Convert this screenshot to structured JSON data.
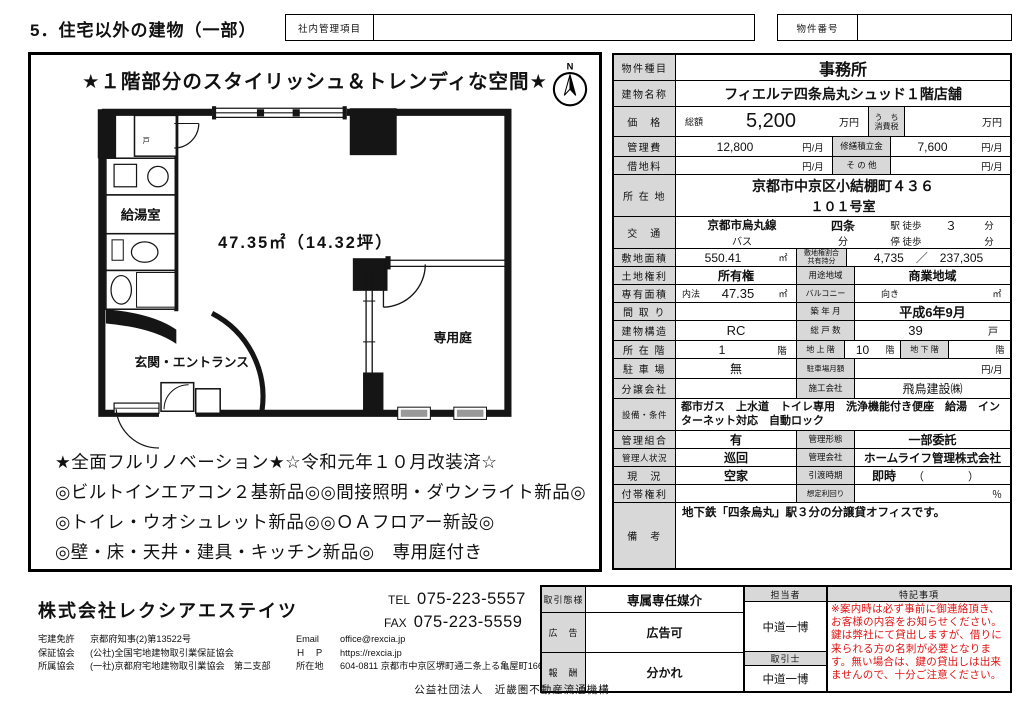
{
  "colors": {
    "label_bg": "#d8d8d8",
    "notes_red": "#e01212",
    "line": "#000000"
  },
  "header": {
    "title": "5．住宅以外の建物（一部）",
    "internal_label": "社内管理項目",
    "internal_value": "",
    "property_no_label": "物件番号",
    "property_no_value": ""
  },
  "plan": {
    "headline": "★１階部分のスタイリッシュ＆トレンディな空間★",
    "compass_n": "N",
    "door_label": "戸",
    "room_kyuto": "給湯室",
    "area_text": "47.35㎡（14.32坪）",
    "room_entrance": "玄関・エントランス",
    "room_garden": "専用庭",
    "features": [
      "★全面フルリノベーション★☆令和元年１０月改装済☆",
      "◎ビルトインエアコン２基新品◎◎間接照明・ダウンライト新品◎",
      "◎トイレ・ウオシュレット新品◎◎ＯＡフロアー新設◎",
      "◎壁・床・天井・建具・キッチン新品◎　専用庭付き"
    ]
  },
  "spec": {
    "type_label": "物件種目",
    "type": "事務所",
    "name_label": "建物名称",
    "name": "フィエルテ四条烏丸シュッド１階店舗",
    "price_label": "価　格",
    "price_prefix": "総額",
    "price": "5,200",
    "price_unit": "万円",
    "tax_label1": "う　ち",
    "tax_label2": "消費税",
    "tax_value": "",
    "tax_unit": "万円",
    "mgmt_label": "管理費",
    "mgmt": "12,800",
    "mgmt_unit": "円/月",
    "repair_label": "修繕積立金",
    "repair": "7,600",
    "repair_unit": "円/月",
    "rent_label": "借地料",
    "rent": "",
    "rent_unit": "円/月",
    "other_label": "そ の 他",
    "other": "",
    "other_unit": "円/月",
    "addr_label": "所 在 地",
    "addr1": "京都市中京区小結棚町４３６",
    "addr2": "１０１号室",
    "access_label": "交　通",
    "line": "京都市烏丸線",
    "station": "四条",
    "walk_label": "駅 徒歩",
    "walk": "３",
    "walk_unit": "分",
    "bus_label": "バス",
    "bus_unit": "分",
    "stop_label": "停 徒歩",
    "stop": "",
    "stop_unit": "分",
    "site_label": "敷地面積",
    "site": "550.41",
    "site_unit": "㎡",
    "share_label1": "敷地権割合",
    "share_label2": "共有持分",
    "share": "4,735　／　237,305",
    "right_label": "土地権利",
    "right": "所有権",
    "zone_label": "用途地域",
    "zone": "商業地域",
    "area_label": "専有面積",
    "area_method": "内法",
    "area": "47.35",
    "area_unit": "㎡",
    "balcony_label": "バルコニー",
    "facing_label": "向き",
    "facing_unit": "㎡",
    "madori_label": "間 取 り",
    "madori": "",
    "built_label": "築 年 月",
    "built": "平成6年9月",
    "structure_label": "建物構造",
    "structure": "RC",
    "units_label": "総 戸 数",
    "units": "39",
    "units_unit": "戸",
    "floor_label": "所 在 階",
    "floor": "1",
    "floor_unit": "階",
    "above_label": "地 上 階",
    "above": "10",
    "above_unit": "階",
    "below_label": "地 下 階",
    "below": "",
    "below_unit": "階",
    "parking_label": "駐 車 場",
    "parking": "無",
    "pmonthly_label": "駐車場月額",
    "pmonthly": "",
    "pmonthly_unit": "円/月",
    "dev_label": "分譲会社",
    "dev": "",
    "builder_label": "施工会社",
    "builder": "飛鳥建設㈱",
    "equip_label": "設備・条件",
    "equip": "都市ガス　上水道　トイレ専用　洗浄機能付き便座　給湯　インターネット対応　自動ロック",
    "hoa_label": "管理組合",
    "hoa": "有",
    "form_label": "管理形態",
    "form": "一部委託",
    "mgr_label": "管理人状況",
    "mgr": "巡回",
    "mco_label": "管理会社",
    "mco": "ホームライフ管理株式会社",
    "status_label": "現　況",
    "status": "空家",
    "handover_label": "引渡時期",
    "handover": "即時",
    "handover_paren": "（　　　　）",
    "extra_label": "付帯権利",
    "extra": "",
    "yield_label": "想定利回り",
    "yield": "",
    "yield_unit": "％",
    "remarks_label": "備　考",
    "remarks": "地下鉄「四条烏丸」駅３分の分譲貸オフィスです。"
  },
  "footer": {
    "company": "株式会社レクシアエステイツ",
    "tel_label": "TEL",
    "tel": "075-223-5557",
    "fax_label": "FAX",
    "fax": "075-223-5559",
    "license_label": "宅建免許",
    "license": "京都府知事(2)第13522号",
    "guarantee_label": "保証協会",
    "guarantee": "(公社)全国宅地建物取引業保証協会",
    "assoc_label": "所属協会",
    "assoc": "(一社)京都府宅地建物取引業協会　第二支部",
    "email_label": "Email",
    "email": "office@rexcia.jp",
    "hp_label": "Ｈ　Ｐ",
    "hp": "https://rexcia.jp",
    "office_label": "所在地",
    "office": "604-0811 京都市中京区堺町通二条上る亀屋町166番地1",
    "deal_label": "取引態様",
    "deal": "専属専任媒介",
    "ad_label": "広　告",
    "ad": "広告可",
    "fee_label": "報　酬",
    "fee": "分かれ",
    "rep_label": "担当者",
    "rep": "中道一博",
    "agent_label": "取引士",
    "agent": "中道一博",
    "notes_label": "特記事項",
    "notes": "※案内時は必ず事前に御連絡頂き、お客様の内容をお知らせください。鍵は弊社にて貸出しますが、借りに来られる方の名刺が必要となります。無い場合は、鍵の貸出しは出来ませんので、十分ご注意ください。",
    "org": "公益社団法人　近畿圏不動産流通機構"
  }
}
